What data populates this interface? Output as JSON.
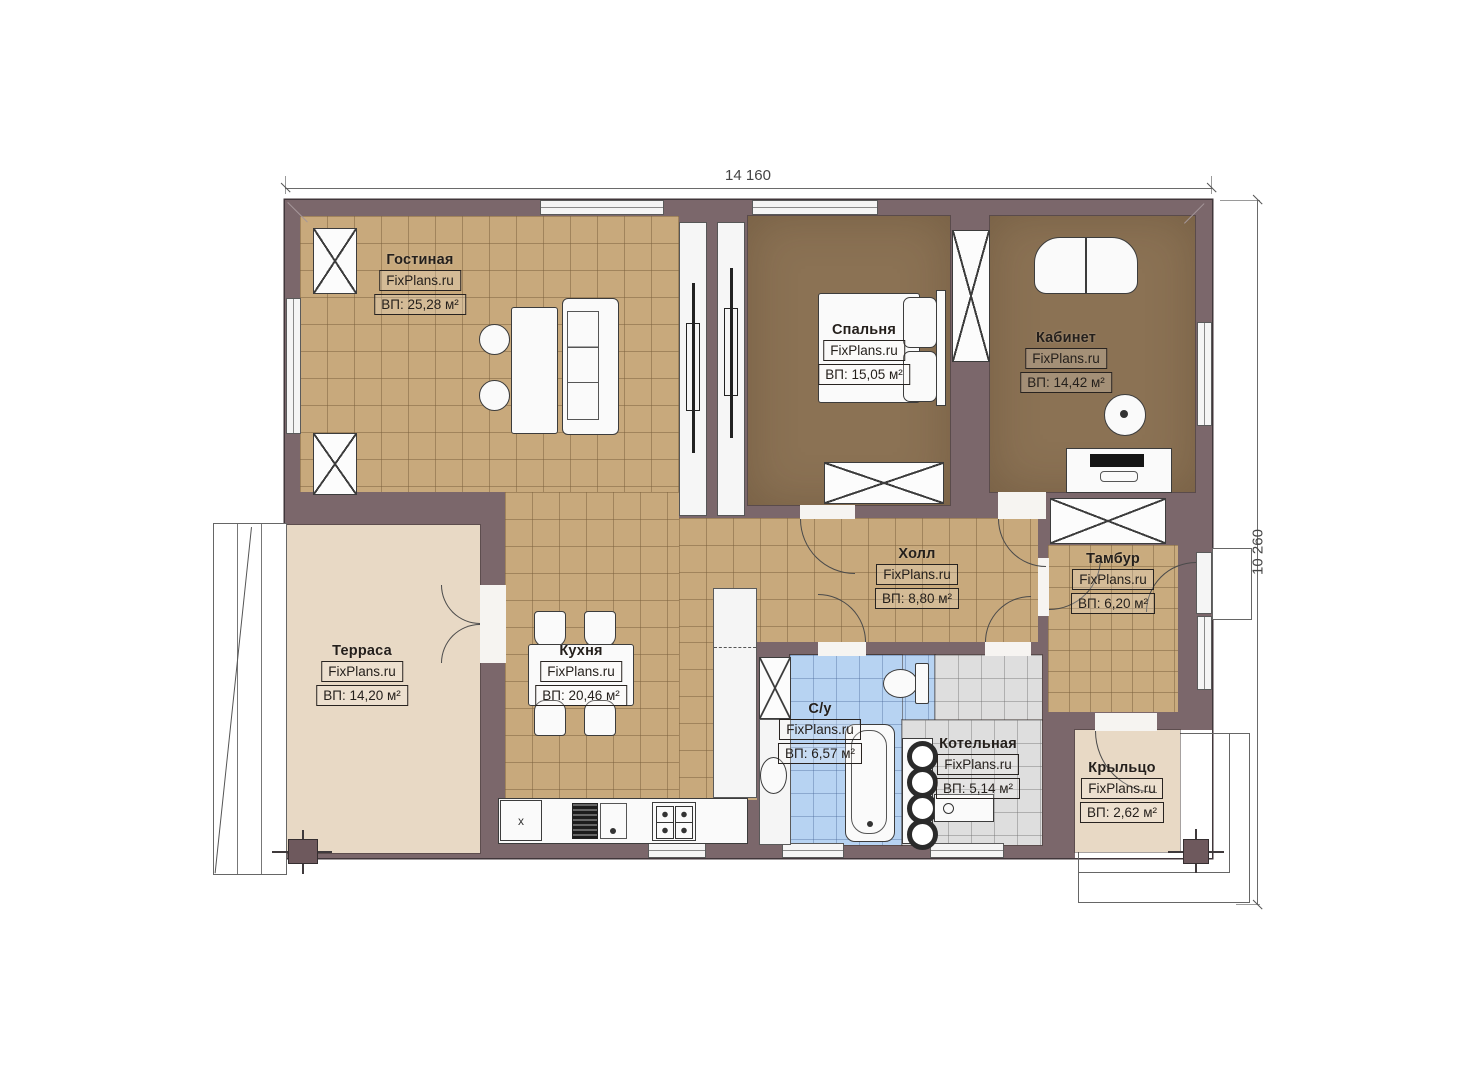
{
  "dimensions": {
    "width_label": "14 160",
    "height_label": "10 260"
  },
  "watermark": "FixPlans.ru",
  "rooms": [
    {
      "name": "Гостиная",
      "area": "ВП: 25,28 м²"
    },
    {
      "name": "Спальня",
      "area": "ВП: 15,05 м²"
    },
    {
      "name": "Кабинет",
      "area": "ВП: 14,42 м²"
    },
    {
      "name": "Холл",
      "area": "ВП: 8,80 м²"
    },
    {
      "name": "Тамбур",
      "area": "ВП: 6,20 м²"
    },
    {
      "name": "Терраса",
      "area": "ВП: 14,20 м²"
    },
    {
      "name": "Кухня",
      "area": "ВП: 20,46 м²"
    },
    {
      "name": "С/у",
      "area": "ВП: 6,57 м²"
    },
    {
      "name": "Котельная",
      "area": "ВП: 5,14 м²"
    },
    {
      "name": "Крыльцо",
      "area": "ВП: 2,62 м²"
    }
  ],
  "fixtures": {
    "fridge_mark": "x"
  },
  "colors": {
    "wall": "#7b676b",
    "wall_outline": "#40363a",
    "tile_tan": "#c8a97c",
    "floor_dark": "#8b7254",
    "tile_blue": "#b7d3f2",
    "tile_gray": "#dedede",
    "deck_beige": "#e8d9c5",
    "furniture": "#fafafa",
    "line": "#3c3c3c"
  }
}
